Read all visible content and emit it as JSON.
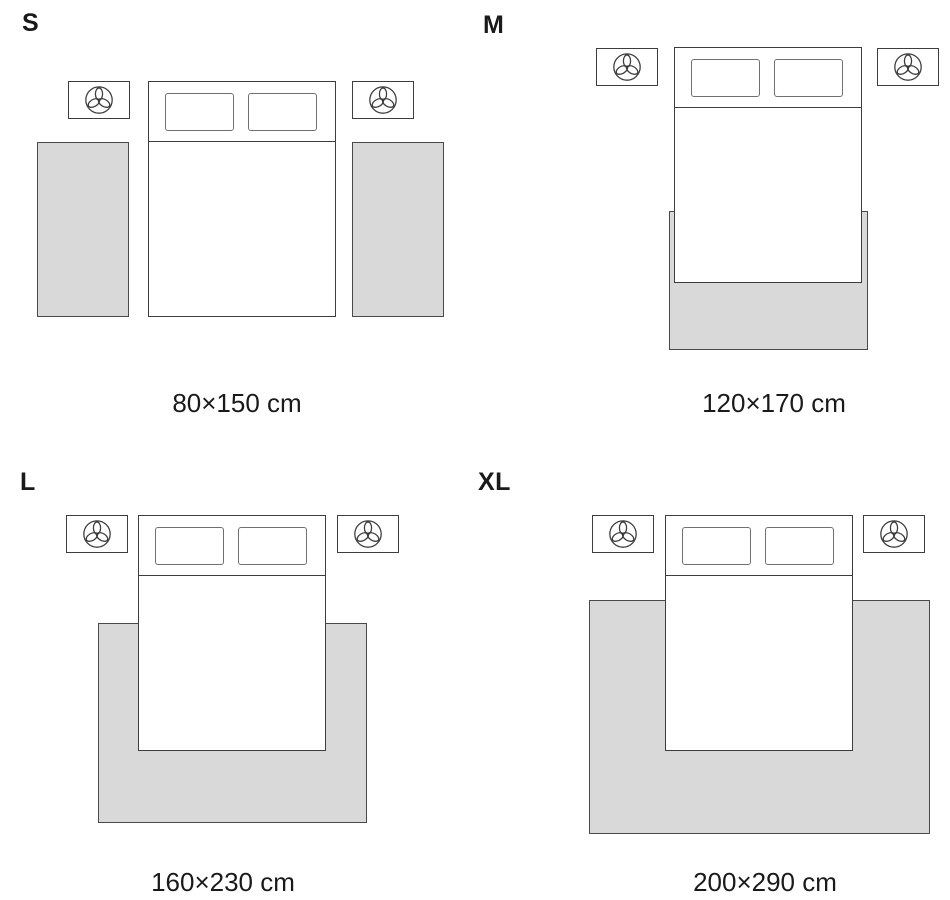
{
  "diagram": "bed-rug-size-guide",
  "colors": {
    "line": "#3d3d3d",
    "pillow_line": "#707070",
    "rug_fill": "#d9d9d9",
    "rug_line": "#4a4a4a",
    "text": "#1a1a1a",
    "bg": "#ffffff"
  },
  "icons": {
    "nightstand_decor": "plant-top-view-icon"
  },
  "panels": [
    {
      "letter": "S",
      "size_label": "80×150 cm",
      "rug_layout": "two bedside runner rugs, one on each side of the bed"
    },
    {
      "letter": "M",
      "size_label": "120×170 cm",
      "rug_layout": "rug under the lower half of the bed, extending past the foot"
    },
    {
      "letter": "L",
      "size_label": "160×230 cm",
      "rug_layout": "wide rug under the lower two-thirds of the bed, extending on three sides"
    },
    {
      "letter": "XL",
      "size_label": "200×290 cm",
      "rug_layout": "extra-wide rug spanning beyond the nightstands, under most of the bed"
    }
  ]
}
